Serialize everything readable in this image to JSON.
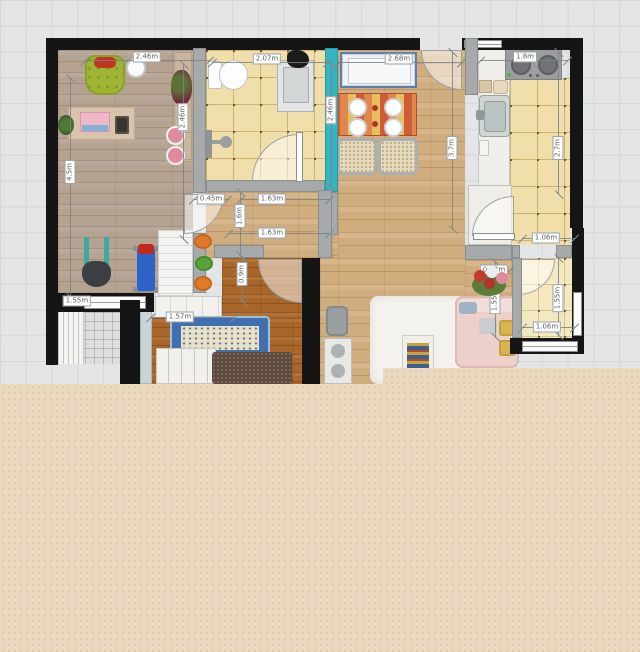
{
  "plan": {
    "dims": {
      "study_width": "2.46m",
      "study_height": "2.46m",
      "study_wall_left": "4.5m",
      "study_window": "1.55m",
      "bath_width": "2.07m",
      "dining_width": "2.68m",
      "dining_left": "2.46m",
      "dining_height": "3.7m",
      "kitchen_width": "1.8m",
      "kitchen_height": "2.7m",
      "hall_niche": "0.45m",
      "hall_width_upper": "1.63m",
      "hall_depth": "1.6m",
      "hall_width_lower": "1.63m",
      "bedroom_entry_depth": "0.9m",
      "bedroom_width": "1.57m",
      "balcony_width_top": "1.06m",
      "balcony_step": "0.22m",
      "balcony_depth_left": "1.55m",
      "balcony_depth_right": "1.55m",
      "balcony_width_bottom": "1.06m"
    },
    "colors": {
      "accent_wall": "#35b4c1",
      "mask_beige": "#ead9c1",
      "grid_background": "#e3e5e6",
      "wall_black": "#151515"
    }
  }
}
